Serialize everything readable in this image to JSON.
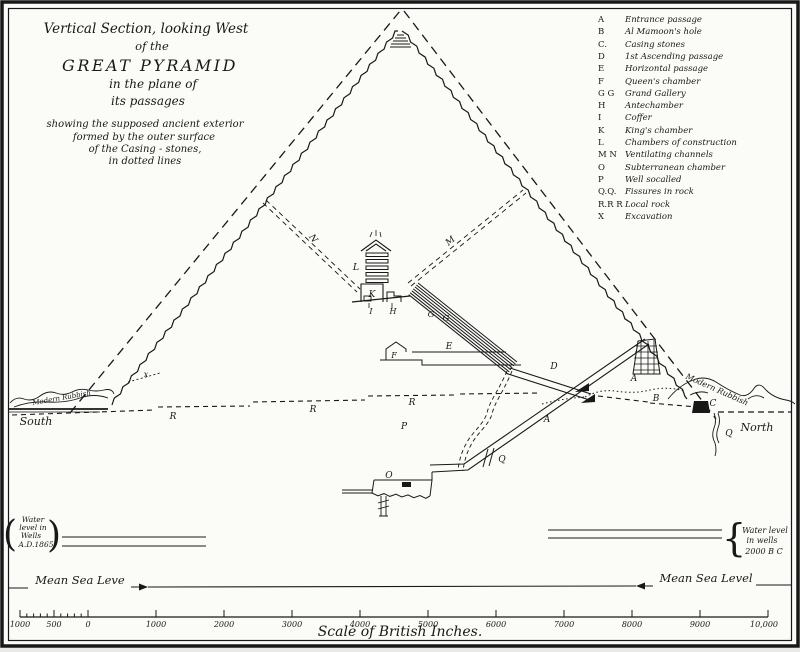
{
  "title": {
    "line1": "Vertical Section, looking West",
    "line2": "of the",
    "line3": "GREAT PYRAMID",
    "line4": "in the plane of",
    "line5": "its passages",
    "sub1": "showing the supposed ancient exterior",
    "sub2": "formed by the outer surface",
    "sub3": "of the Casing - stones,",
    "sub4": "in dotted lines"
  },
  "legend": {
    "items": [
      {
        "key": "A",
        "label": "Entrance passage"
      },
      {
        "key": "B",
        "label": "Al Mamoon's hole"
      },
      {
        "key": "C.",
        "label": "Casing stones"
      },
      {
        "key": "D",
        "label": "1st Ascending passage"
      },
      {
        "key": "E",
        "label": "Horizontal passage"
      },
      {
        "key": "F",
        "label": "Queen's chamber"
      },
      {
        "key": "G G",
        "label": "Grand Gallery"
      },
      {
        "key": "H",
        "label": "Antechamber"
      },
      {
        "key": "I",
        "label": "Coffer"
      },
      {
        "key": "K",
        "label": "King's chamber"
      },
      {
        "key": "L",
        "label": "Chambers of construction"
      },
      {
        "key": "M N",
        "label": "Ventilating channels"
      },
      {
        "key": "O",
        "label": "Subterranean chamber"
      },
      {
        "key": "P",
        "label": "Well socalled"
      },
      {
        "key": "Q.Q.",
        "label": "Fissures in rock"
      },
      {
        "key": "R.R R",
        "label": "Local rock"
      },
      {
        "key": "X",
        "label": "Excavation"
      }
    ]
  },
  "diagram": {
    "letters": {
      "a": "A",
      "b": "B",
      "c": "C",
      "d": "D",
      "e": "E",
      "f": "F",
      "g": "G",
      "h": "H",
      "i": "I",
      "k": "K",
      "l": "L",
      "m": "M",
      "n": "N",
      "o": "O",
      "p": "P",
      "q": "Q",
      "r": "R",
      "x": "x"
    },
    "south": "South",
    "north": "North",
    "rubbish_left": "Modern Rubbish",
    "rubbish_right": "Modern Rubbish"
  },
  "water_left": {
    "l1": "Water",
    "l2": "level in",
    "l3": "Wells",
    "l4": "A.D.1865"
  },
  "water_right": {
    "l1": "Water level",
    "l2": "in wells",
    "l3": "2000 B C"
  },
  "sea_level": {
    "left": "Mean Sea Leve",
    "right": "Mean Sea Level"
  },
  "scale": {
    "caption": "Scale of British Inches.",
    "labels": [
      "1000",
      "500",
      "0",
      "1000",
      "2000",
      "3000",
      "4000",
      "5000",
      "6000",
      "7000",
      "8000",
      "9000",
      "10,000"
    ]
  }
}
